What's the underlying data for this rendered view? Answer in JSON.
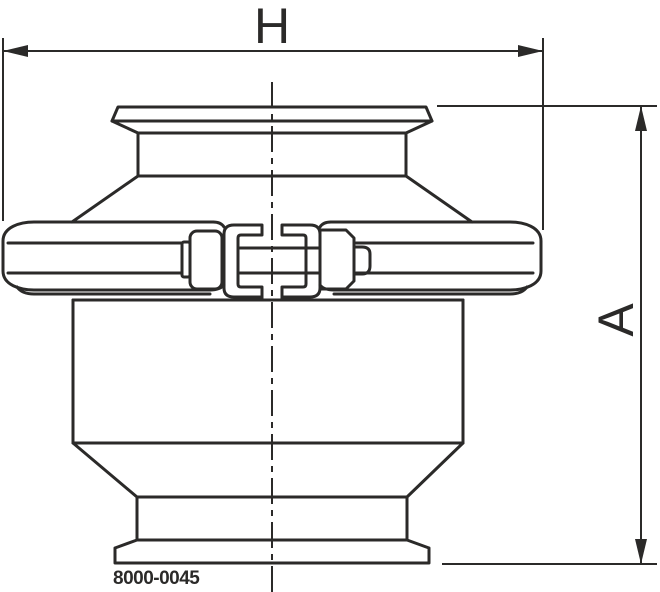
{
  "drawing": {
    "dimensions": {
      "width_label": "H",
      "height_label": "A"
    },
    "drawing_number": "8000-0045",
    "colors": {
      "line": "#2b2a29",
      "background": "#ffffff"
    }
  }
}
